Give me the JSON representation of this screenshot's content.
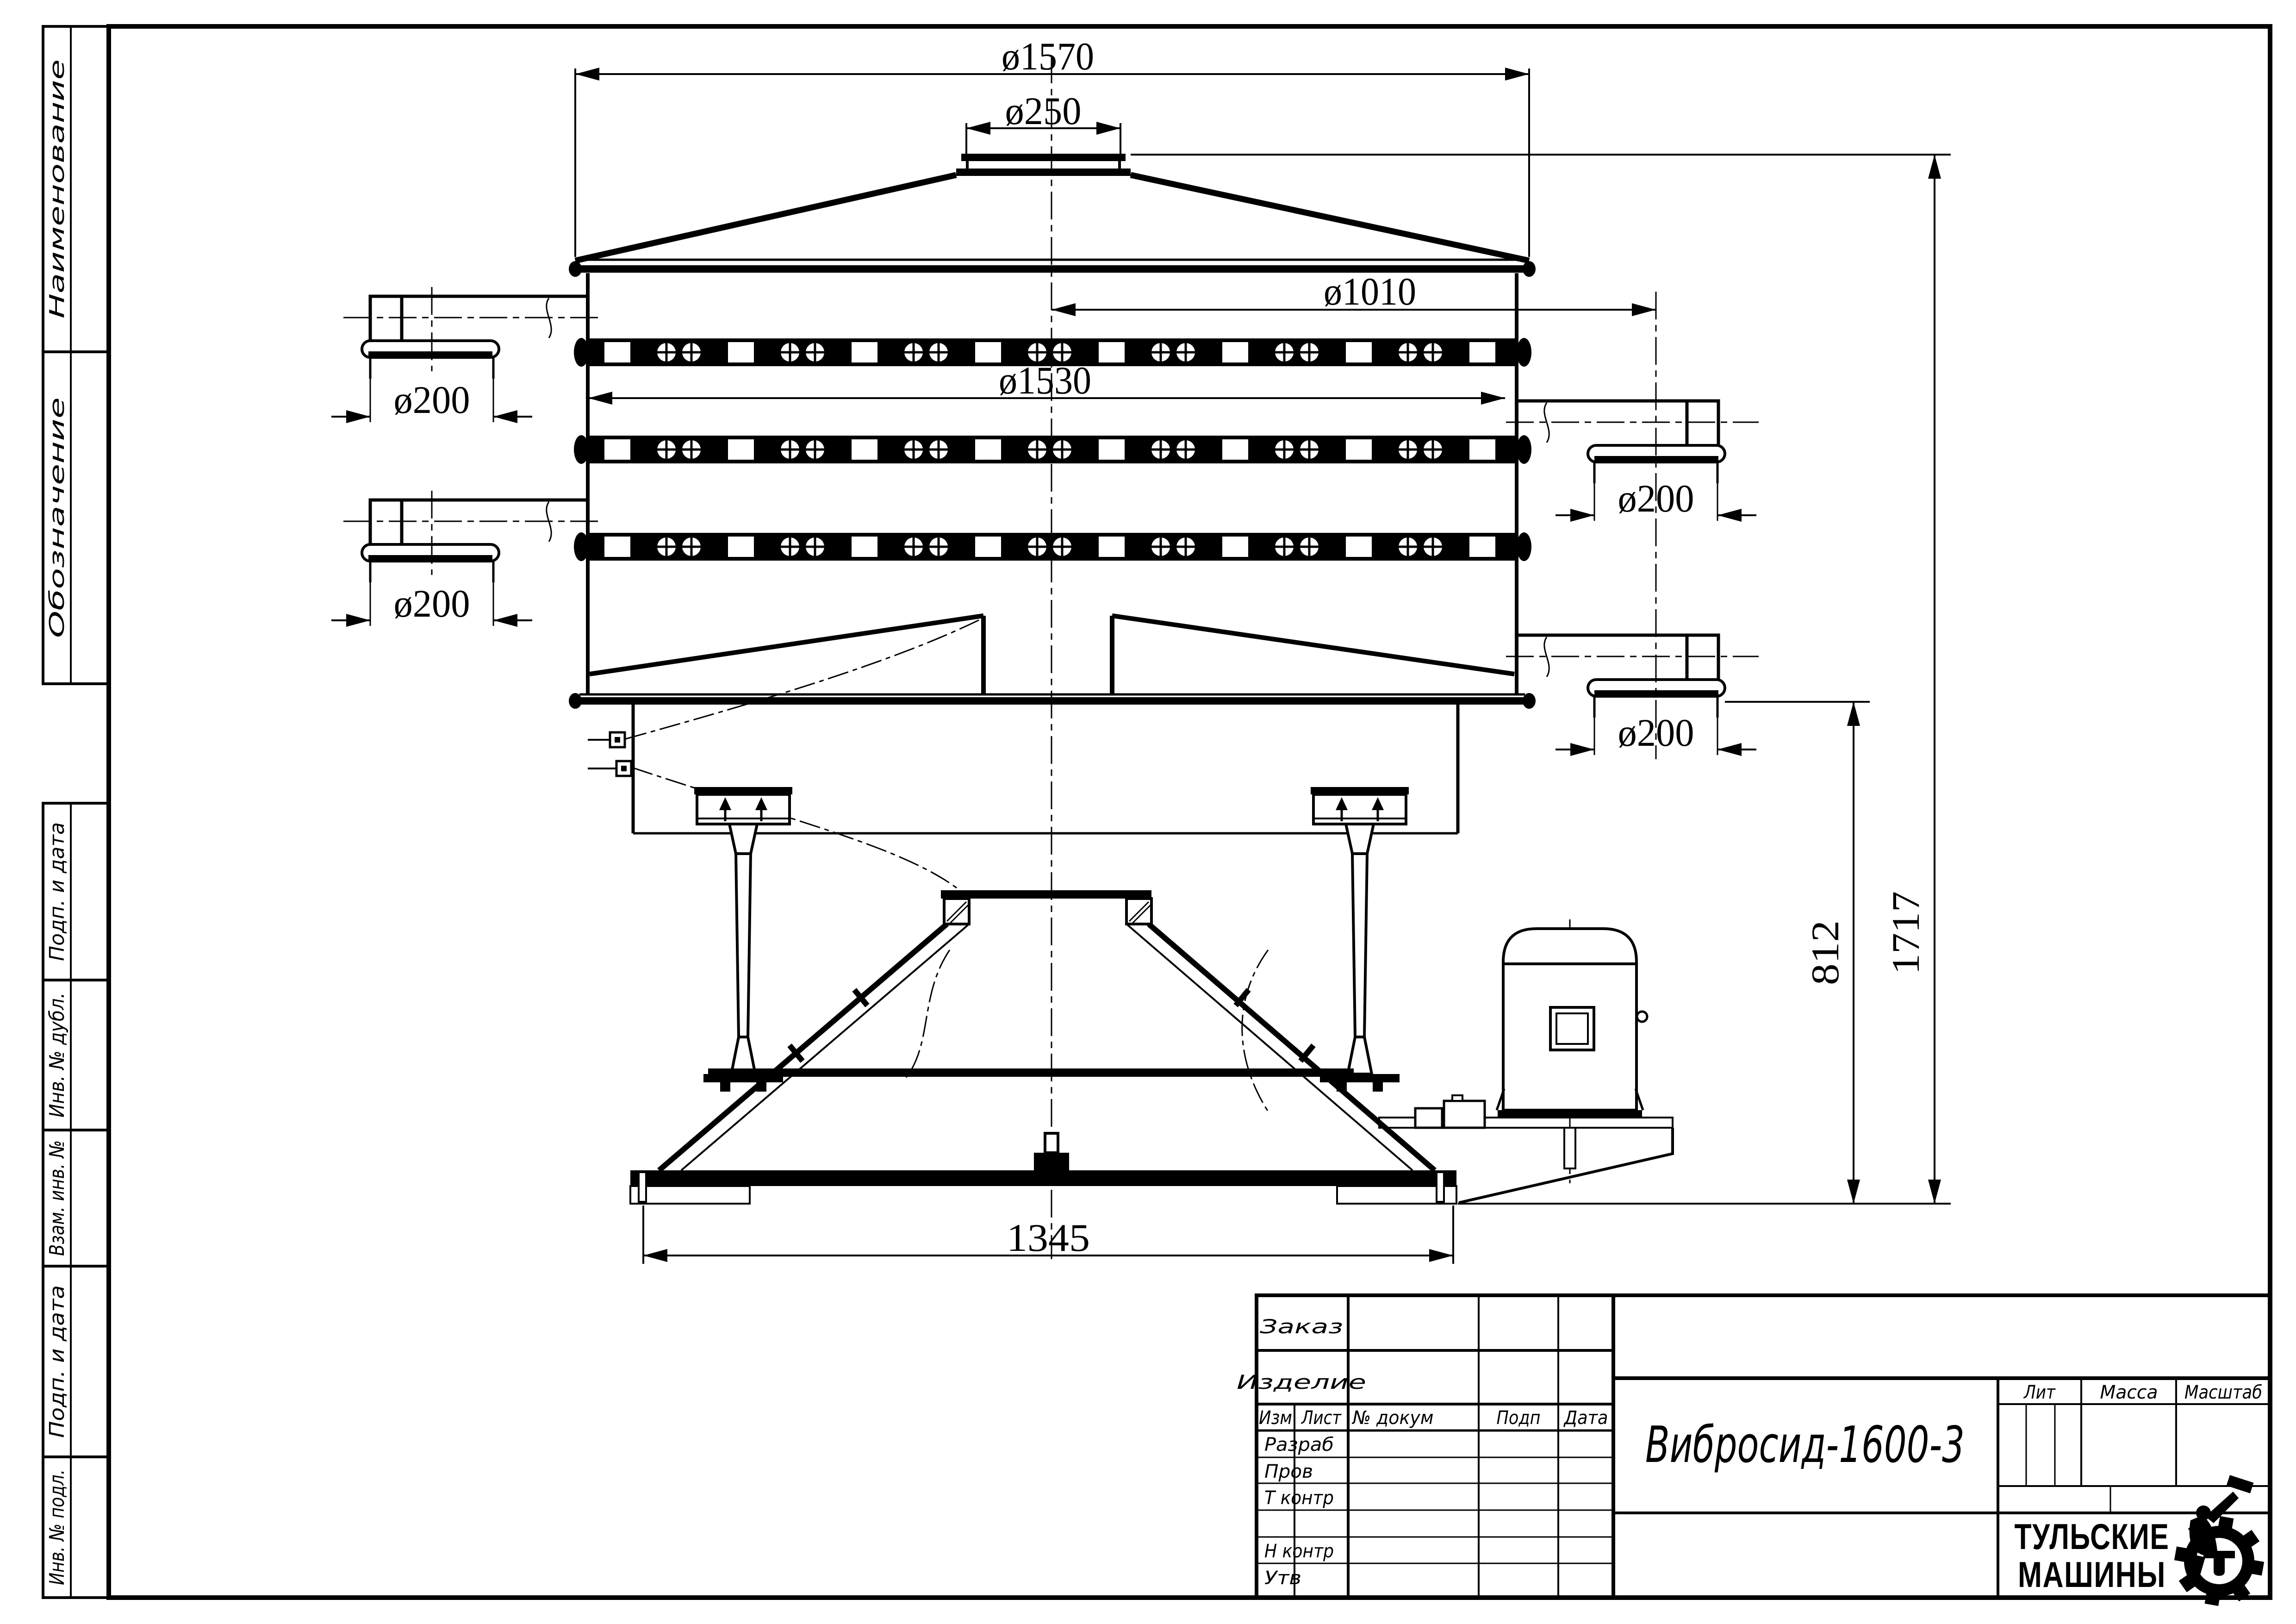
{
  "drawing": {
    "dimensions": {
      "top_diameter": "ø1570",
      "inlet_diameter": "ø250",
      "deck_diameter": "ø1010",
      "body_diameter": "ø1530",
      "outlet_diameter": "ø200",
      "outlet_height": "812",
      "total_height": "1717",
      "base_width": "1345"
    }
  },
  "margin_labels": {
    "top": [
      "Наименование",
      "Обозначение"
    ],
    "bottom": [
      "Подп. и дата",
      "Инв. № дубл.",
      "Взам. инв. №",
      "Подп. и дата",
      "Инв. № подл."
    ]
  },
  "title_block": {
    "order_label": "Заказ",
    "product_label": "Изделие",
    "header": [
      "Изм",
      "Лист",
      "№ докум",
      "Подп",
      "Дата"
    ],
    "staff_rows": [
      "Разраб",
      "Пров",
      "Т контр",
      "Н контр",
      "Утв"
    ],
    "designation": "Вибросид-1600-3",
    "lit_label": "Лит",
    "mass_label": "Масса",
    "scale_label": "Масштаб",
    "company": [
      "ТУЛЬСКИЕ",
      "МАШИНЫ"
    ]
  }
}
